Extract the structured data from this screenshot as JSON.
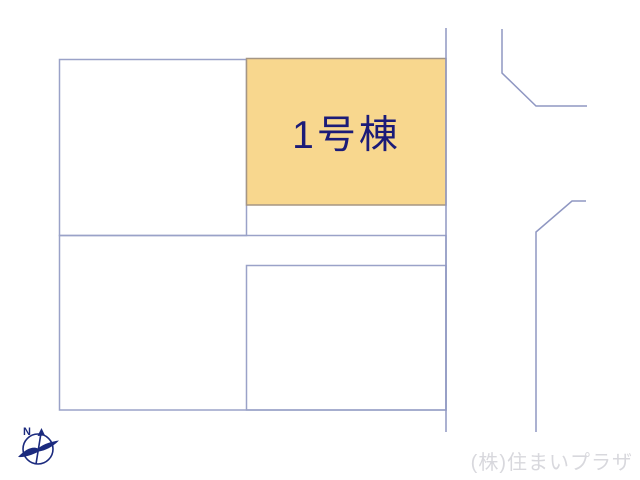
{
  "site_plan": {
    "line_color": "#9AA2C8",
    "road_line_color": "#8F97C2",
    "lots": {
      "building1": {
        "label": "1号棟",
        "fill": "#F8D78E",
        "border": "#A59683",
        "label_color": "#1B1B78"
      }
    }
  },
  "compass": {
    "north_label": "N",
    "color": "#1B2A7E"
  },
  "watermark": {
    "text": "(株)住まいプラザ",
    "color": "#D8D8DD"
  }
}
